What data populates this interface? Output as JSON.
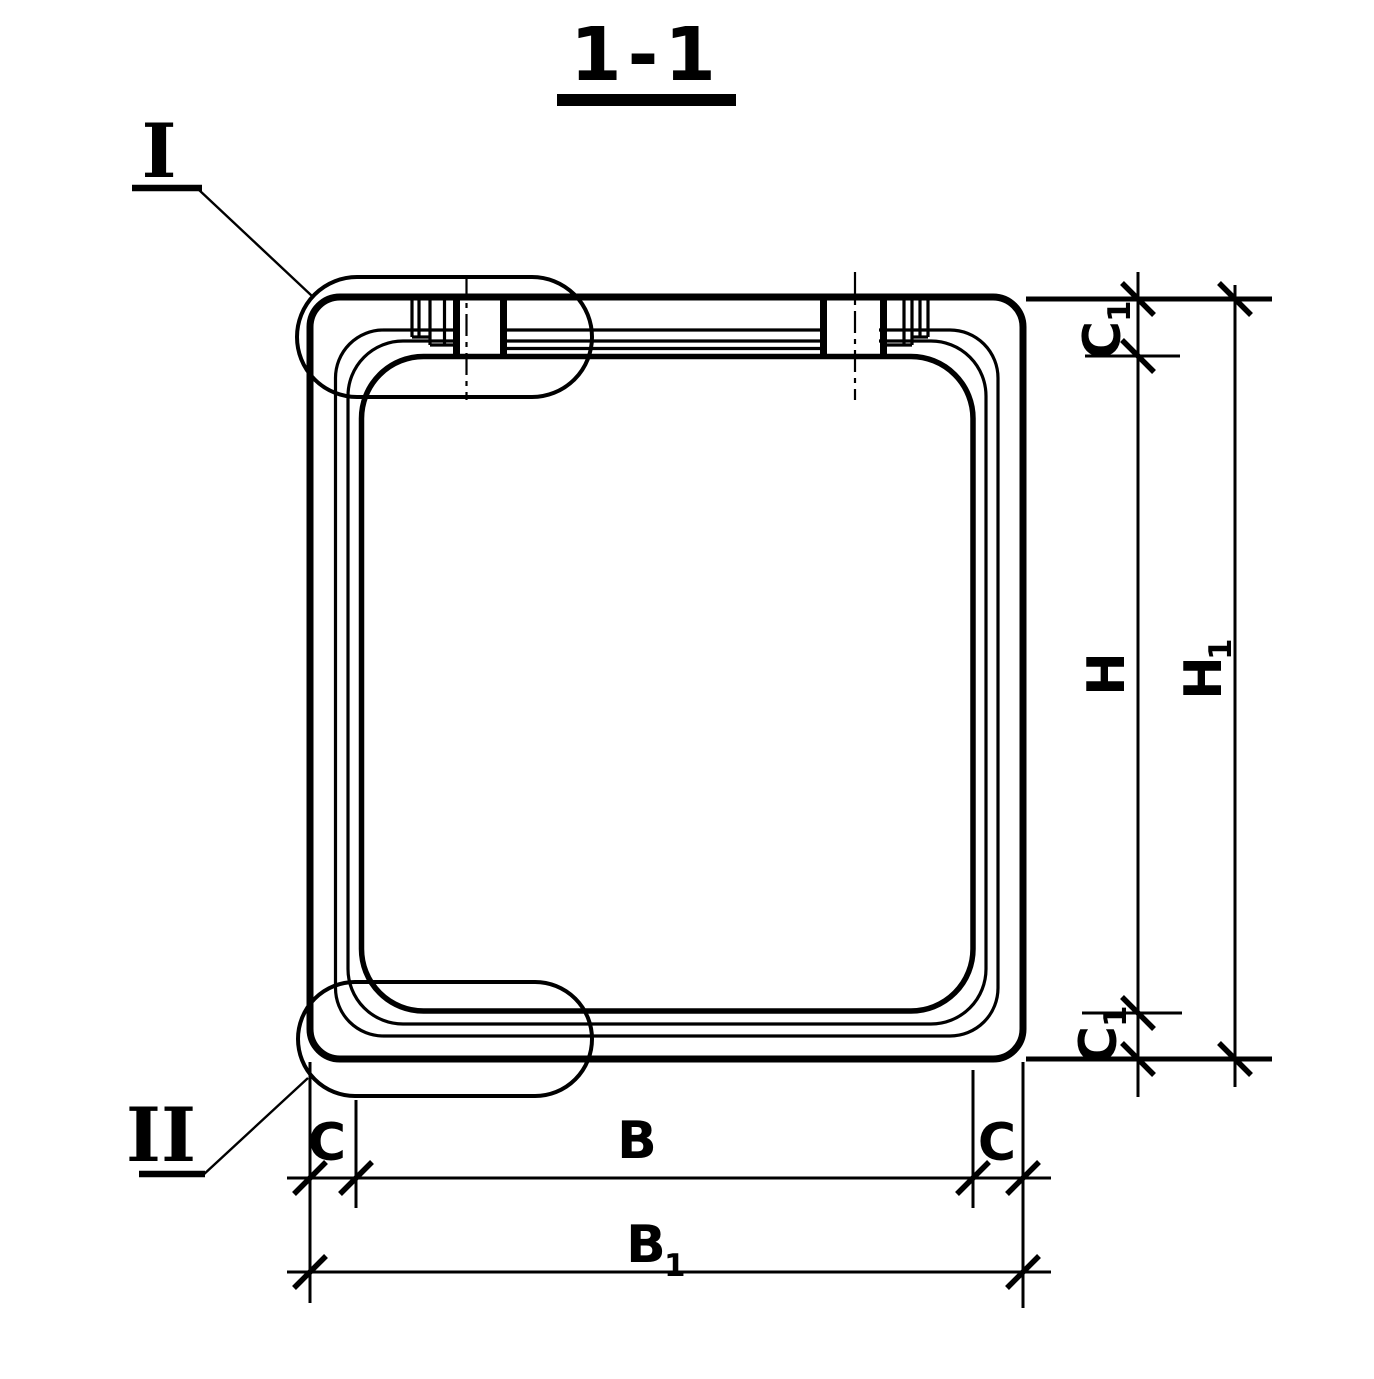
{
  "drawing": {
    "title": "1-1",
    "background": "#ffffff",
    "line_color": "#000000"
  },
  "details": {
    "detail_i": "I",
    "detail_ii": "II"
  },
  "dimensions": {
    "c1_top": {
      "main": "C",
      "sub": "1"
    },
    "h": {
      "main": "H"
    },
    "h1": {
      "main": "H",
      "sub": "1"
    },
    "c1_bottom": {
      "main": "C",
      "sub": "1"
    },
    "c_left": "C",
    "b": "B",
    "c_right": "C",
    "b1": {
      "main": "B",
      "sub": "1"
    }
  }
}
